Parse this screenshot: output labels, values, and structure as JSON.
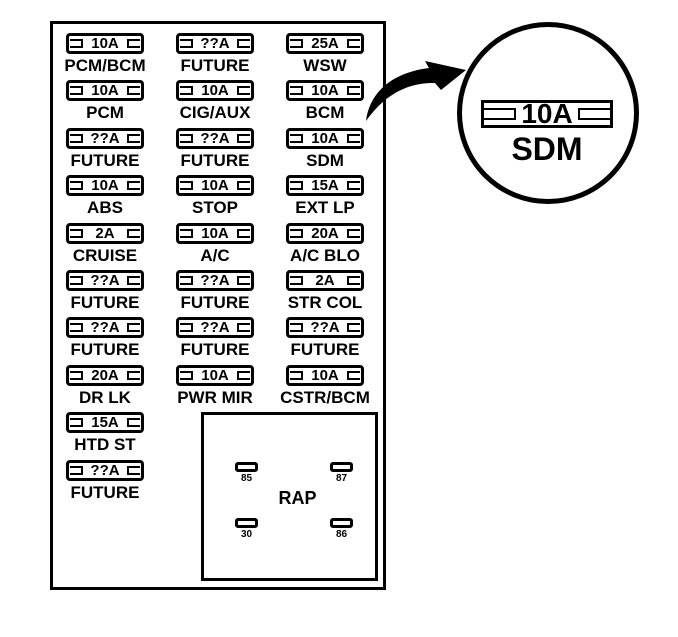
{
  "colors": {
    "line": "#000000",
    "background": "#ffffff"
  },
  "columns": [
    {
      "fuses": [
        {
          "amp": "10A",
          "label": "PCM/BCM"
        },
        {
          "amp": "10A",
          "label": "PCM"
        },
        {
          "amp": "??A",
          "label": "FUTURE"
        },
        {
          "amp": "10A",
          "label": "ABS"
        },
        {
          "amp": "2A",
          "label": "CRUISE"
        },
        {
          "amp": "??A",
          "label": "FUTURE"
        },
        {
          "amp": "??A",
          "label": "FUTURE"
        },
        {
          "amp": "20A",
          "label": "DR LK"
        },
        {
          "amp": "15A",
          "label": "HTD ST"
        },
        {
          "amp": "??A",
          "label": "FUTURE"
        }
      ]
    },
    {
      "fuses": [
        {
          "amp": "??A",
          "label": "FUTURE"
        },
        {
          "amp": "10A",
          "label": "CIG/AUX"
        },
        {
          "amp": "??A",
          "label": "FUTURE"
        },
        {
          "amp": "10A",
          "label": "STOP"
        },
        {
          "amp": "10A",
          "label": "A/C"
        },
        {
          "amp": "??A",
          "label": "FUTURE"
        },
        {
          "amp": "??A",
          "label": "FUTURE"
        },
        {
          "amp": "10A",
          "label": "PWR MIR"
        }
      ]
    },
    {
      "fuses": [
        {
          "amp": "25A",
          "label": "WSW"
        },
        {
          "amp": "10A",
          "label": "BCM"
        },
        {
          "amp": "10A",
          "label": "SDM"
        },
        {
          "amp": "15A",
          "label": "EXT LP"
        },
        {
          "amp": "20A",
          "label": "A/C BLO"
        },
        {
          "amp": "2A",
          "label": "STR COL"
        },
        {
          "amp": "??A",
          "label": "FUTURE"
        },
        {
          "amp": "10A",
          "label": "CSTR/BCM"
        }
      ]
    }
  ],
  "relay": {
    "label": "RAP",
    "pins": [
      {
        "id": "85"
      },
      {
        "id": "87"
      },
      {
        "id": "30"
      },
      {
        "id": "86"
      }
    ]
  },
  "callout": {
    "amp": "10A",
    "label": "SDM"
  }
}
